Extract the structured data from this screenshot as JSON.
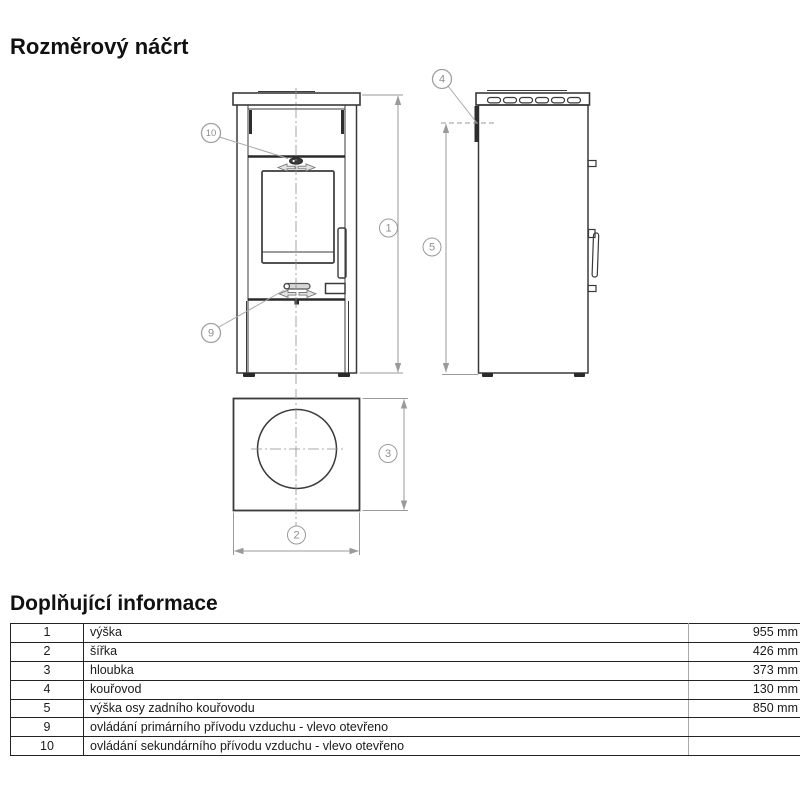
{
  "page": {
    "title": "Rozměrový náčrt"
  },
  "info_section": {
    "title": "Doplňující informace"
  },
  "drawing": {
    "callouts": {
      "height": "1",
      "width": "2",
      "depth": "3",
      "flue": "4",
      "flue_axis": "5",
      "primary_air": "9",
      "secondary_air": "10"
    }
  },
  "table": {
    "rows": [
      {
        "num": "1",
        "label": "výška",
        "value": "955 mm"
      },
      {
        "num": "2",
        "label": "šířka",
        "value": "426 mm"
      },
      {
        "num": "3",
        "label": "hloubka",
        "value": "373 mm"
      },
      {
        "num": "4",
        "label": "kouřovod",
        "value": "130 mm"
      },
      {
        "num": "5",
        "label": "výška osy zadního kouřovodu",
        "value": "850 mm"
      },
      {
        "num": "9",
        "label": "ovládání primárního přívodu vzduchu - vlevo otevřeno",
        "value": ""
      },
      {
        "num": "10",
        "label": "ovládání sekundárního přívodu vzduchu - vlevo otevřeno",
        "value": ""
      }
    ]
  },
  "colors": {
    "line_dark": "#3a3a3a",
    "line_thick": "#2a2a2a",
    "dim_gray": "#9a9a9a",
    "table_border": "#222222",
    "background": "#ffffff"
  }
}
